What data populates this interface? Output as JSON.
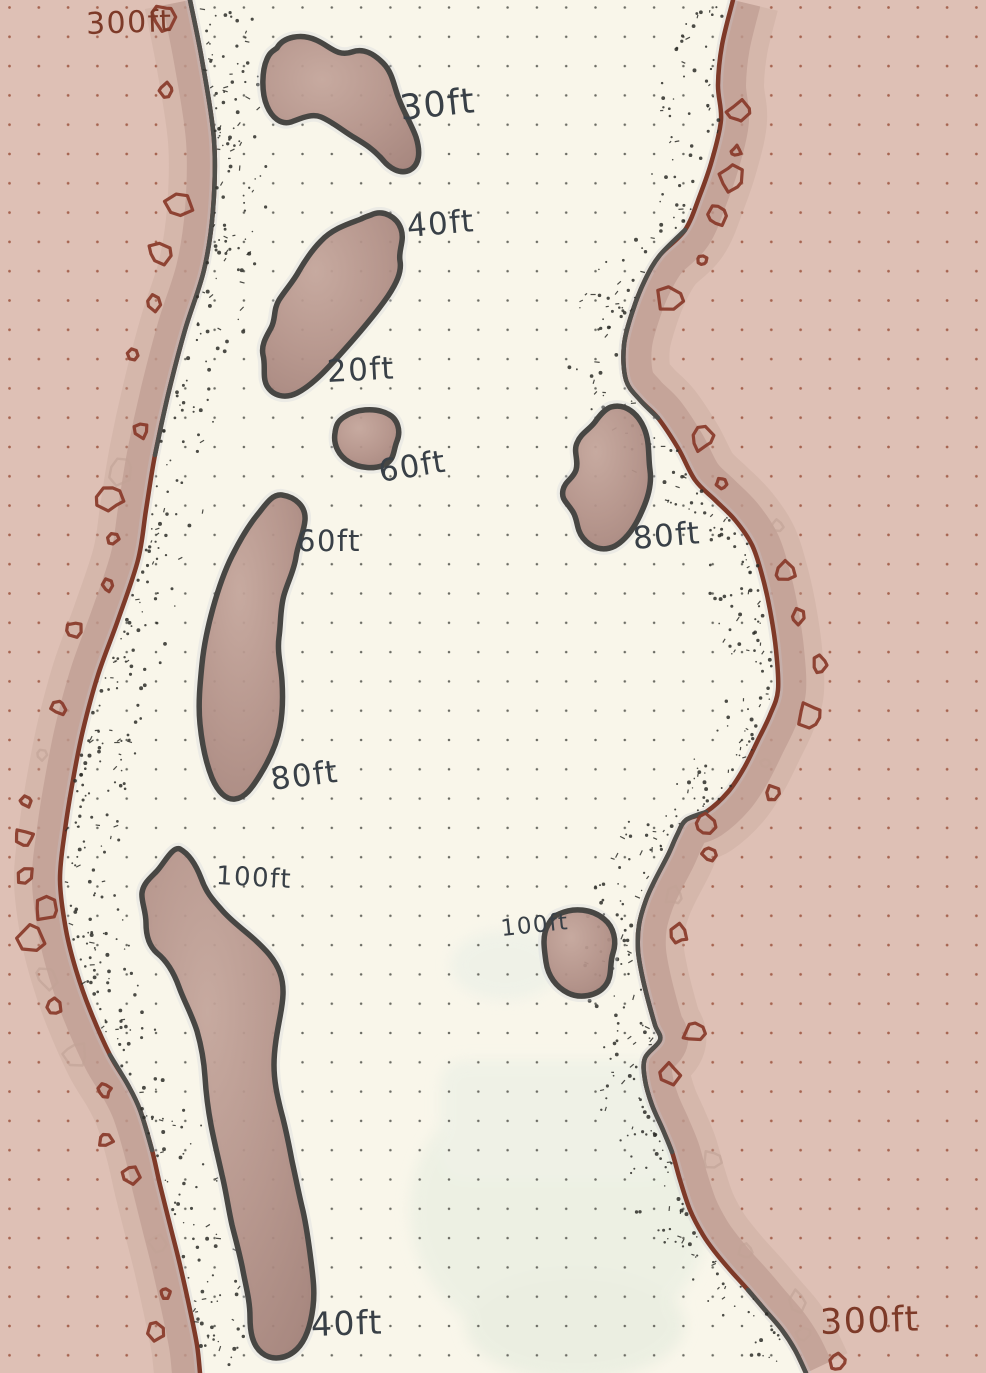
{
  "map": {
    "description": "Hand-drawn channel map with depth soundings on dot-grid paper",
    "shore_labels": {
      "top_left": "300ft",
      "bottom_right": "300ft"
    },
    "depth_labels": {
      "island_a": "30ft",
      "island_b_top": "40ft",
      "island_b_bottom": "20ft",
      "island_c": "60ft",
      "island_d_top": "60ft",
      "island_e": "80ft",
      "island_d_bottom": "80ft",
      "island_f_top": "100ft",
      "island_g": "100ft",
      "island_f_bottom": "40ft"
    },
    "palette": {
      "paper": "#f9f6ea",
      "land_pink": "#dec0b5",
      "shore_band": "#bd9b91",
      "island_fill": "#ab887f",
      "island_outline": "#474643",
      "rock_red": "#8a3c2c",
      "shoreline_red": "#7e3928",
      "shoreline_gray": "#4f4e4a",
      "ink_dark": "#394047",
      "ink_red": "#7d3a28"
    }
  }
}
